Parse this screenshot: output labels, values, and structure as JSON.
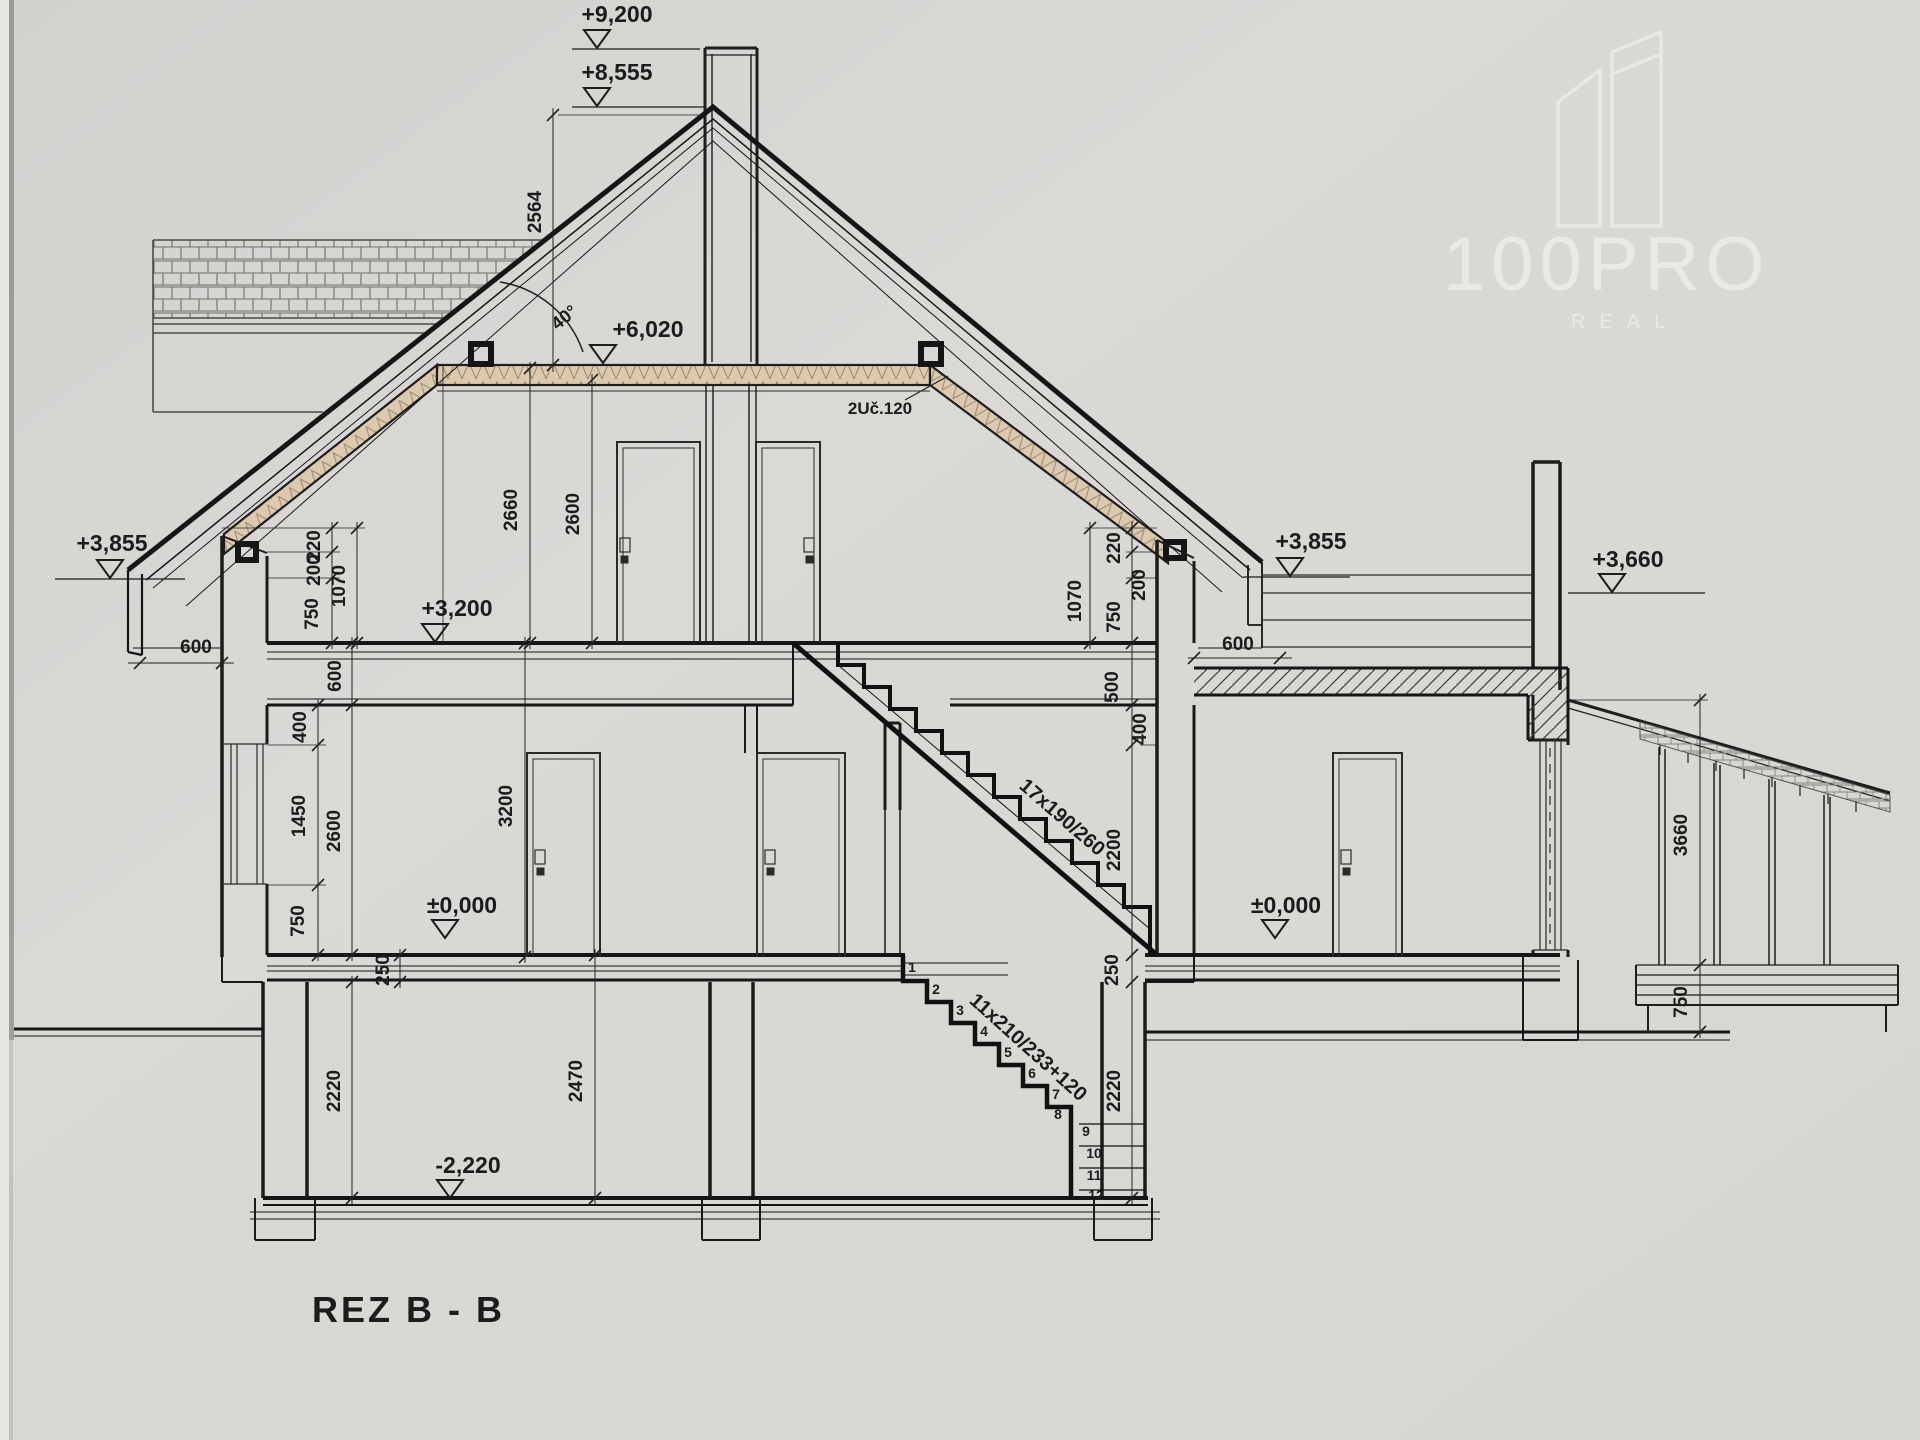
{
  "title": {
    "label": "REZ B - B"
  },
  "logo": {
    "brand": "100PRO",
    "sub": "REAL"
  },
  "levels": {
    "v9200": "+9,200",
    "v8555": "+8,555",
    "v6020": "+6,020",
    "v3855": "+3,855",
    "v3660": "+3,660",
    "v3200": "+3,200",
    "v0": "±0,000",
    "vm2220": "-2,220"
  },
  "annotations": {
    "roof_angle": "40°",
    "beam": "2Uč.120",
    "stair_upper": "17x190/260",
    "stair_lower": "11x210/233+120"
  },
  "dims": {
    "d2564": "2564",
    "d2660": "2660",
    "d2600": "2600",
    "d220": "220",
    "d200": "200",
    "d1070": "1070",
    "d750": "750",
    "d600": "600",
    "d500": "500",
    "d400": "400",
    "d1450": "1450",
    "d3200": "3200",
    "d2200": "2200",
    "d2220": "2220",
    "d2470": "2470",
    "d250": "250",
    "d3660": "3660"
  },
  "steps": [
    "1",
    "2",
    "3",
    "4",
    "5",
    "6",
    "7",
    "8",
    "9",
    "10",
    "11",
    "12"
  ]
}
